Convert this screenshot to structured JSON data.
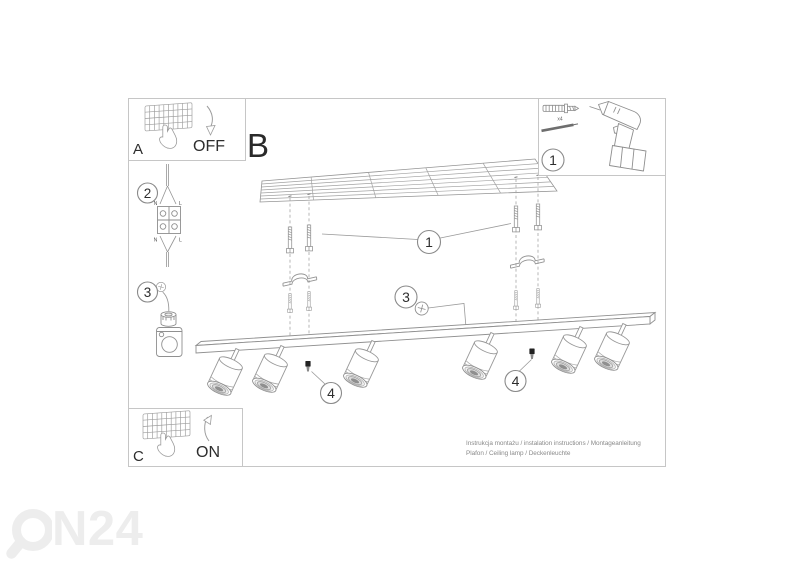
{
  "panels": {
    "main": {
      "label": "B"
    },
    "switch_off": {
      "label": "A",
      "state": "OFF"
    },
    "switch_on": {
      "label": "C",
      "state": "ON"
    },
    "parts": {
      "step": "1",
      "anchor_qty": "x4"
    }
  },
  "steps": {
    "wiring": {
      "num": "2",
      "n_top": "N",
      "l_top": "L",
      "n_bottom": "N",
      "l_bottom": "L"
    },
    "bracket": {
      "num": "3"
    }
  },
  "callouts": {
    "anchors": "1",
    "ground": "3",
    "screw_left": "4",
    "screw_right": "4"
  },
  "footer": {
    "line1": "Instrukcja montażu / instalation instructions / Montageanleitung",
    "line2": "Plafon / Ceiling lamp / Deckenleuchte"
  },
  "watermark": {
    "text": "N24"
  },
  "colors": {
    "line": "#949494",
    "text": "#2d2d2d",
    "border": "#c6c6c6",
    "footer_text": "#8a8a8a",
    "watermark": "#ededed"
  }
}
